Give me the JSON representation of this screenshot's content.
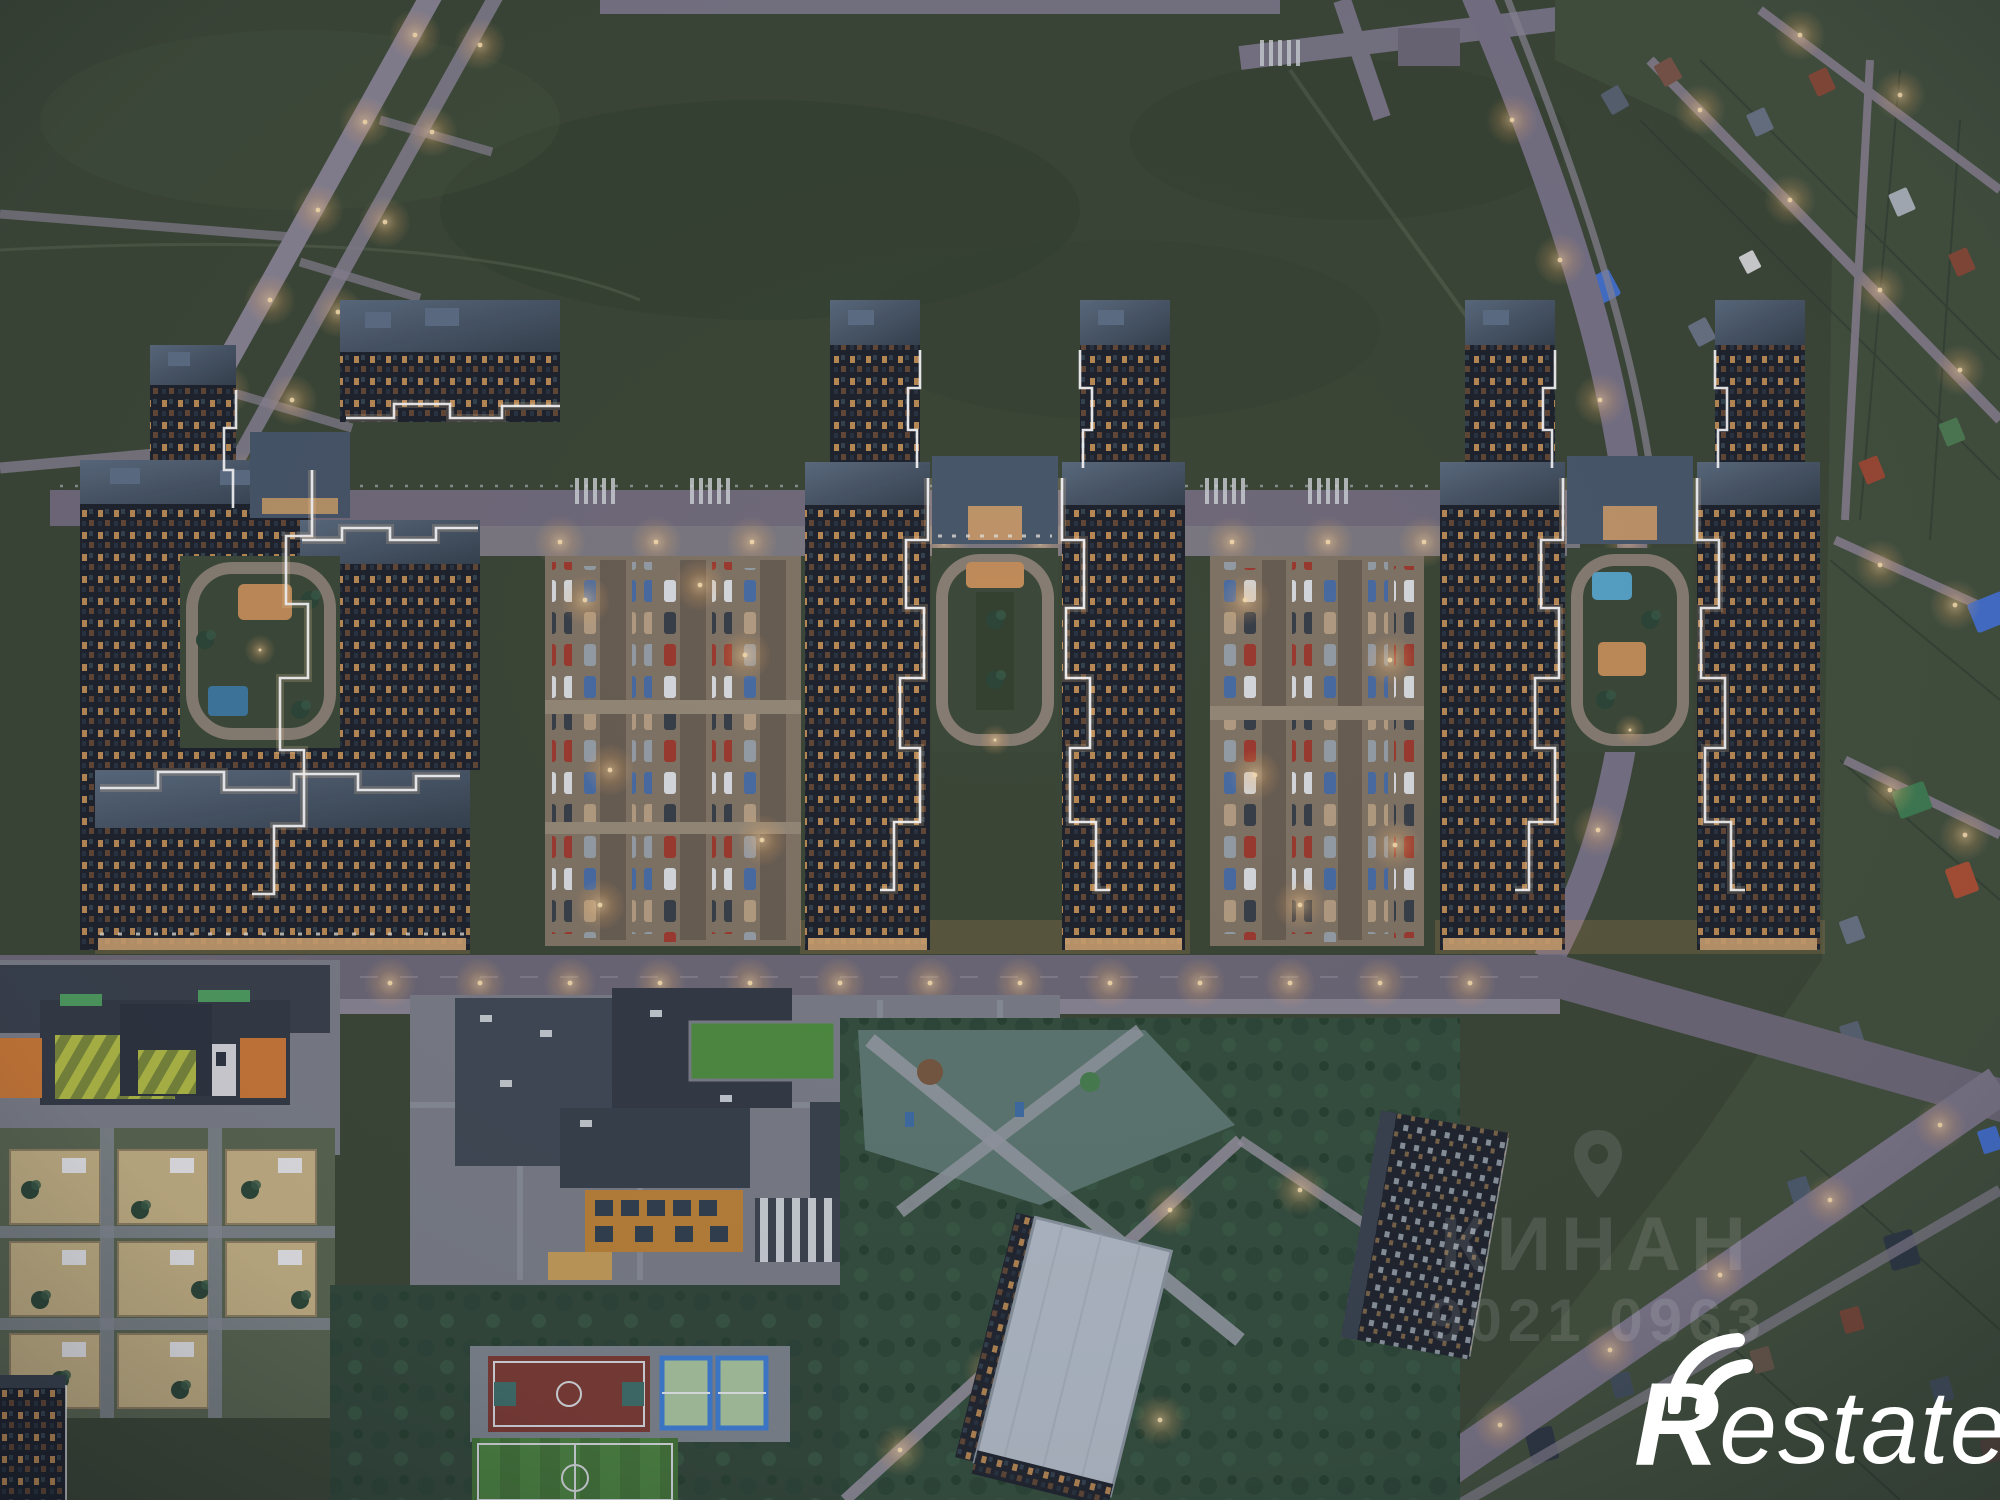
{
  "meta": {
    "description": "Aerial dusk 3D render of a residential complex: three courtyard apartment clusters with white LED rooflines and amber-lit windows, parking lots, a school, a kindergarten, sports courts, a dark green field with a lit boulevard, and a cottage suburb on the right",
    "time_of_day": "dusk"
  },
  "watermarks": {
    "center": {
      "icon": "location-pin-icon",
      "line1": "КИНАН",
      "line2": "9021 0963"
    },
    "brand": {
      "icon": "signal-arcs-icon",
      "first_letter": "R",
      "rest": "estate",
      "full": "Restate"
    }
  },
  "palette": {
    "field": "#3c4836",
    "field_dark": "#333f2e",
    "road": "#736d7d",
    "path": "#8b8594",
    "warm_light": "#f3c07f",
    "roof": "#44536a",
    "roof_light": "#5d6d80",
    "facade": "#1d232b",
    "window_amber": "#f0a95e",
    "led_white": "#ffffff",
    "parking": "#8b7d6b",
    "sand": "#c6b384",
    "plaza_teal": "#5f7a72",
    "grass_roof": "#4f8f3f",
    "soccer_green": "#4a8040",
    "court_red": "#7d3b33",
    "court_green": "#aac7a0",
    "court_blue": "#3f7fd4",
    "pool_blue": "#5aa8cc",
    "kindergarten_orange": "#cd7a36",
    "kindergarten_lime": "#b4bf45",
    "school_orange": "#c08438",
    "suburb_roof_blue": "#4472d0",
    "suburb_roof_red": "#b05033",
    "suburb_roof_green": "#3f7f52",
    "tree": "#2d4737",
    "cars": [
      "#dfe3e6",
      "#394049",
      "#a23b2e",
      "#4a6fa8",
      "#b9a284",
      "#9aa2ab"
    ]
  },
  "scene": {
    "regions": [
      "field",
      "boulevard",
      "back-road",
      "cluster-left",
      "cluster-center",
      "cluster-right",
      "parking-lot-a",
      "parking-lot-b",
      "front-street",
      "kindergarten",
      "school",
      "basketball-court",
      "tennis-courts",
      "soccer-field",
      "park",
      "playground-plaza",
      "tower-light-roof",
      "tower-bottom-right",
      "suburb",
      "right-road",
      "bottom-road"
    ]
  }
}
